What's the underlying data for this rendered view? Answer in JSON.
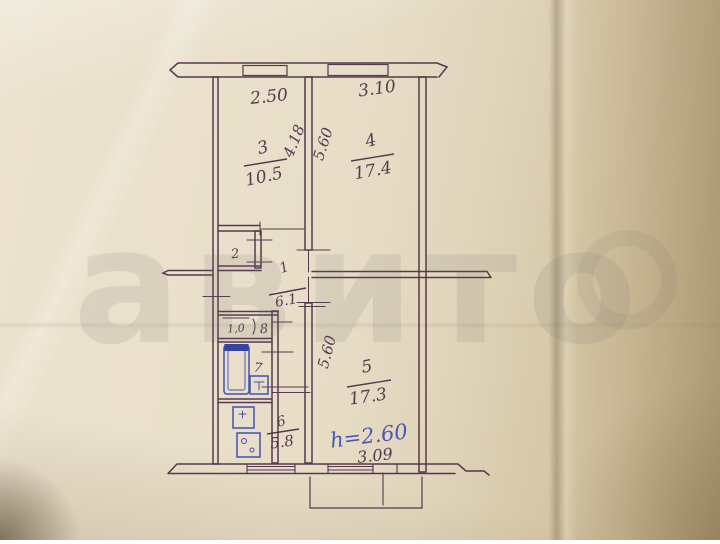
{
  "plan": {
    "watermark": "авито",
    "ink_color": "#4b2b45",
    "blue_ink_color": "#3a4ab2",
    "dims": {
      "room3_width": "2.50",
      "room4_width": "3.10",
      "room3_depth": "4.18",
      "room4_depth": "5.60",
      "room5_depth": "5.60",
      "room5_width": "3.09"
    },
    "rooms": {
      "hall_num": "1",
      "hall_area": "6.1",
      "closet_num": "2",
      "room3_num": "3",
      "room3_area": "10.5",
      "room4_num": "4",
      "room4_area": "17.4",
      "room5_num": "5",
      "room5_area": "17.3",
      "kitchen_num": "6",
      "kitchen_area": "5.8",
      "bath_num": "7",
      "wc_area": "1,0",
      "wc_num": "8"
    },
    "notes": {
      "ceiling_height": "h=2.60"
    }
  }
}
